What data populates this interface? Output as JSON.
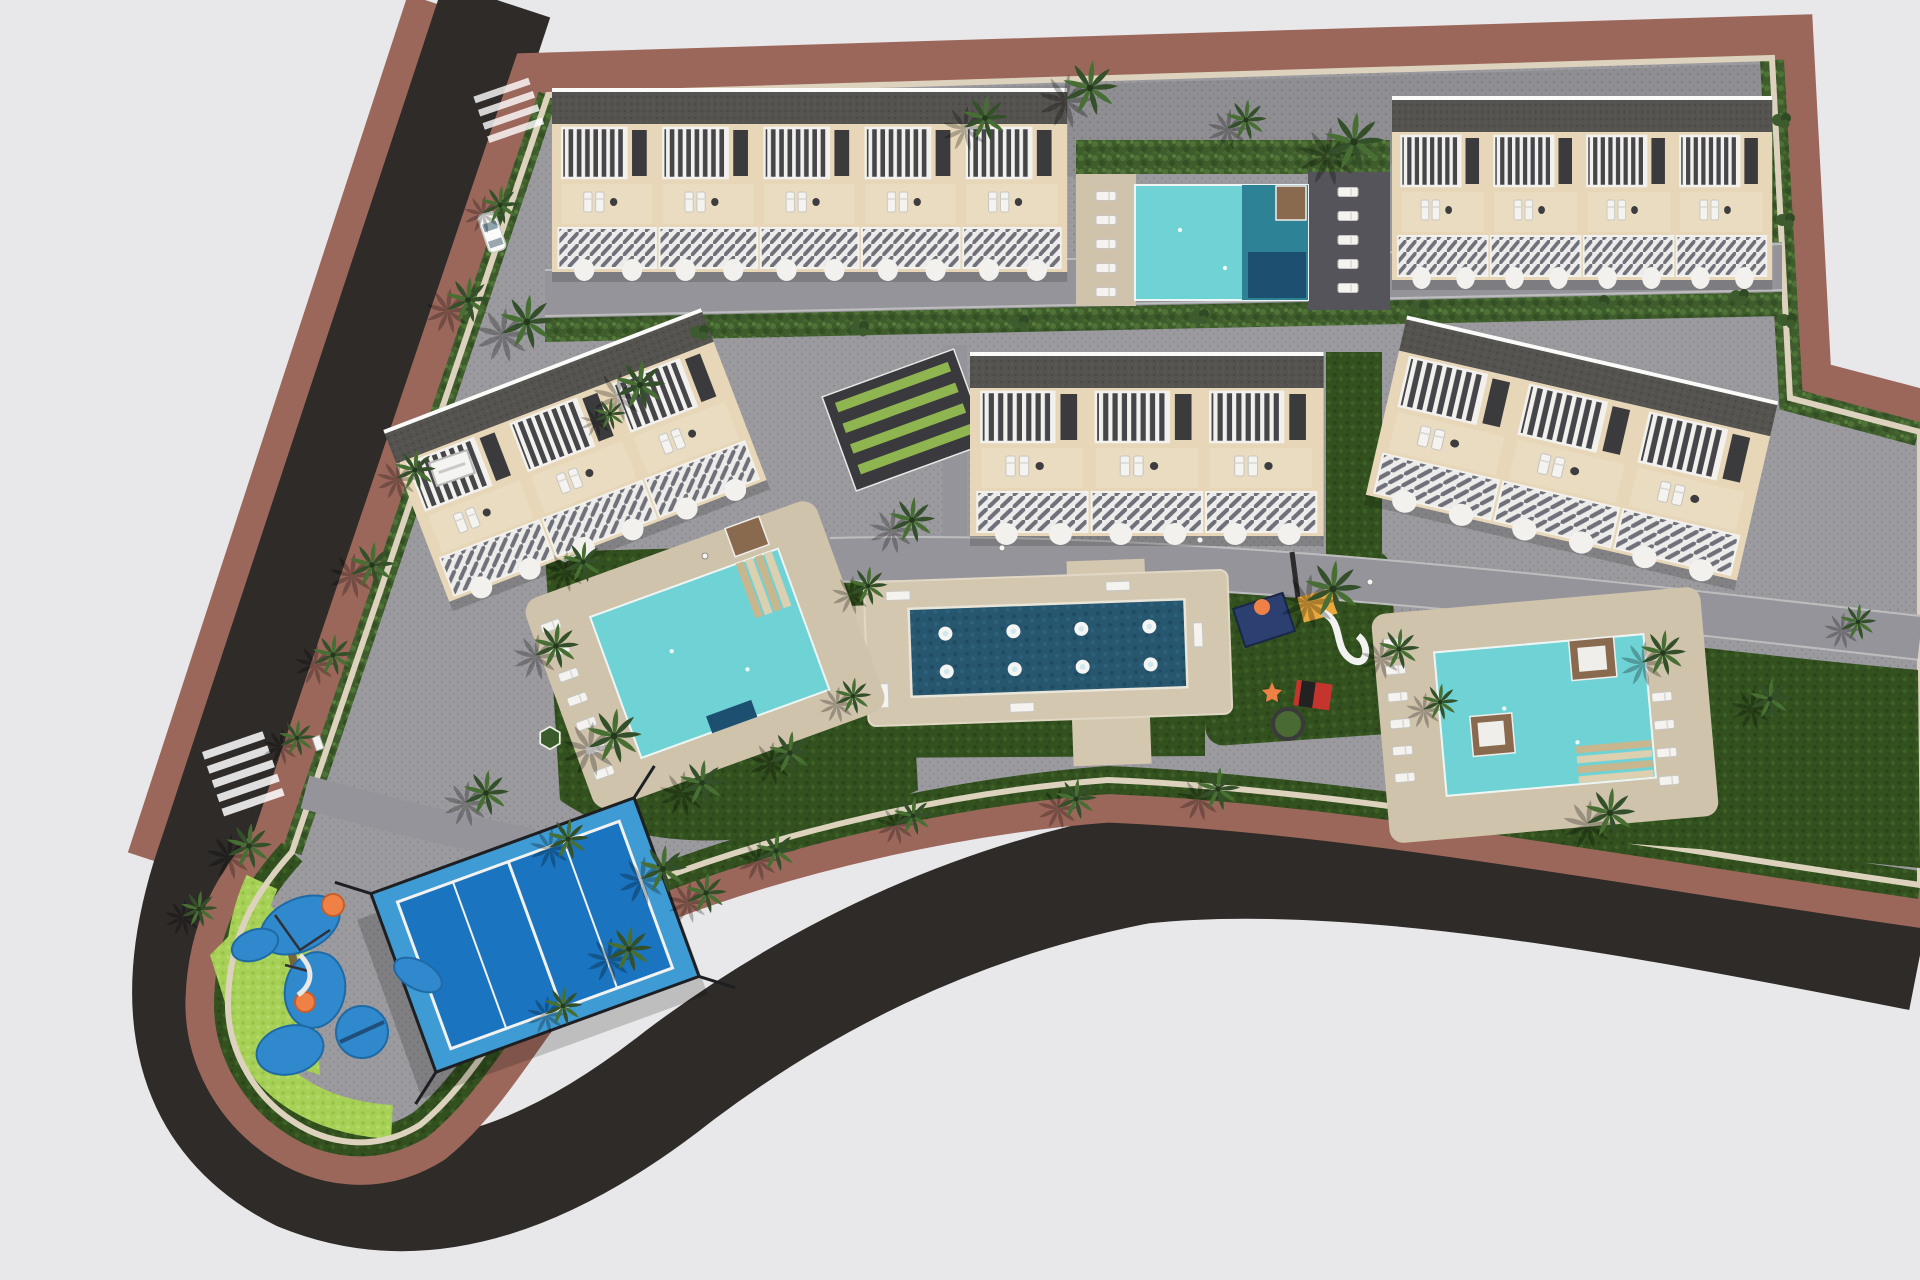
{
  "scene": {
    "description": "Aerial top-down 3D architectural render of a residential development master plan with townhouse blocks, swimming pools, fountain plaza, playgrounds, padel court and palm landscaping, bounded by a curving perimeter road",
    "view": "top-down aerial",
    "style": "photorealistic architectural visualization"
  },
  "palette": {
    "background": "#e8e8ea",
    "asphalt": "#2e2b28",
    "sidewalk_brown": "#9c675b",
    "paving_gray": "#9b9a9e",
    "paving_dark": "#8f8e92",
    "curb_beige": "#dcd2bd",
    "deck_beige": "#cfc3ab",
    "plaza_beige": "#d3c7b0",
    "facade_beige": "#e7d7b8",
    "terrace_beige": "#e9dcc0",
    "railing_white": "#f2f1ee",
    "railing_dark": "#46464a",
    "roof_gray": "#55534f",
    "hedge_green": "#3f5c2c",
    "lawn_green": "#33511f",
    "lime_green": "#a7d057",
    "palm_green": "#33502a",
    "palm_green_light": "#476f33",
    "pool_turquoise": "#6fd2d4",
    "pool_deep_teal": "#2e8296",
    "pool_navy_pad": "#1d4f70",
    "fountain_blue": "#27566f",
    "court_blue": "#1b74bf",
    "court_apron_blue": "#3f9bd4",
    "play_blue": "#2f89cc",
    "play_orange": "#ef8146",
    "play_yellow": "#e9a83d",
    "play_red": "#c6342e",
    "play_navy": "#2b3f70",
    "pergola_brown": "#8a6a4e",
    "sand_tan": "#d8c493",
    "lounger_white": "#f4f3f0"
  },
  "site": {
    "buildings": [
      {
        "id": "north-west-block",
        "units": 5,
        "orientation_deg": 0
      },
      {
        "id": "north-east-block",
        "units": 4,
        "orientation_deg": 0
      },
      {
        "id": "central-block",
        "units": 3,
        "orientation_deg": 0
      },
      {
        "id": "west-block",
        "units": 3,
        "orientation_deg": -21
      },
      {
        "id": "east-block",
        "units": 3,
        "orientation_deg": 13
      }
    ],
    "pools": [
      {
        "id": "north-pool",
        "shape": "rectangular",
        "features": [
          "deck loungers",
          "palm shade",
          "deep end",
          "navy platform",
          "pergola"
        ]
      },
      {
        "id": "west-pool",
        "shape": "rectangular",
        "features": [
          "corner steps",
          "navy platform",
          "pergola",
          "loungers"
        ]
      },
      {
        "id": "east-pool",
        "shape": "rectangular",
        "features": [
          "corner steps",
          "two sun platforms",
          "loungers"
        ]
      }
    ],
    "amenities": [
      {
        "id": "fountain-plaza",
        "jets": 8,
        "basin": "dark blue reflecting pool"
      },
      {
        "id": "children-playground",
        "equipment": [
          "climbing frame",
          "yellow slide",
          "white s-slide",
          "spinner ring",
          "seesaw"
        ]
      },
      {
        "id": "splash-playground",
        "surface": "blue rubber blobs with orange play points"
      },
      {
        "id": "padel-court",
        "surface": "blue",
        "fence": "black"
      }
    ],
    "landscape": {
      "palm_trees": 40,
      "bushes": 10,
      "hedges": "perimeter strip, dividing band and pool screens",
      "lawns": "dark green with beige plaza paths",
      "accent_patches": "lime green hexagons and corner strip"
    },
    "roads": {
      "perimeter": "dark asphalt with reddish-brown sidewalks curving around west and south",
      "internal": "smooth gray lanes with white curbs",
      "crosswalks": 2,
      "vehicles": 1
    }
  }
}
